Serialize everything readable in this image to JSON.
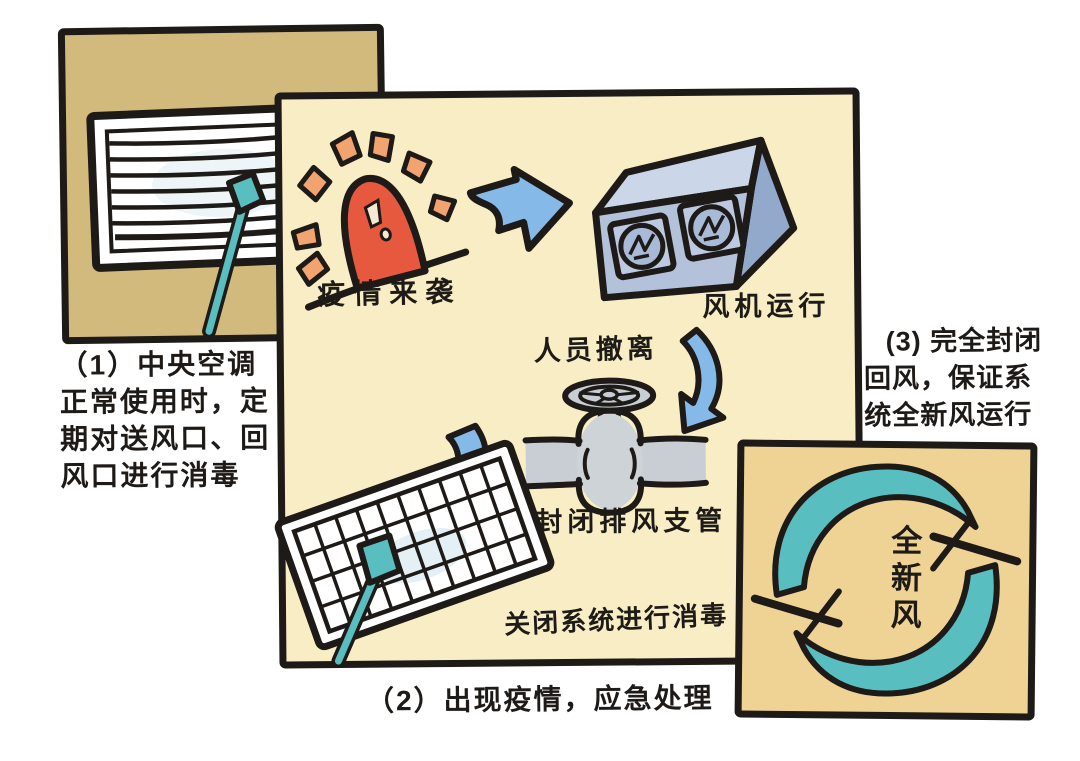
{
  "colors": {
    "ink": "#1d1a17",
    "panel1_bg": "#d2b97c",
    "panel2_bg": "#f8edc4",
    "panel3_bg": "#eed394",
    "arrow_blue": "#85bae8",
    "teal": "#58bec0",
    "siren_red": "#e7593e",
    "ray_orange": "#f2a470",
    "valve_gray": "#c9ced4",
    "fan_front": "#b3c1da",
    "fan_top": "#cbd6e9",
    "fan_side": "#93a9cc",
    "paper": "#ffffff"
  },
  "step1": {
    "caption": "（1）中央空调\n正常使用时，定\n期对送风口、回\n风口进行消毒"
  },
  "step2": {
    "caption": "（2）出现疫情，应急处理",
    "labels": {
      "alarm": "疫情来袭",
      "fan": "风机运行",
      "evacuate": "人员撤离",
      "valve": "封闭排风支管",
      "disinfect": "关闭系统进行消毒"
    }
  },
  "step3": {
    "caption": "(3) 完全封闭\n回风，保证系\n统全新风运行",
    "fresh_air": "全新风"
  },
  "icons": {
    "air-vent-icon": "white louvered grille with teal cleaning swab",
    "siren-icon": "red alarm dome with orange rays",
    "arrow-right-icon": "blue hand-drawn arrow",
    "fan-unit-icon": "3d box with two round fans",
    "curved-arrow-down-icon": "blue crescent arrow",
    "valve-icon": "gray pipe valve with handwheel",
    "small-arrow-down-left-icon": "blue crescent arrow",
    "grille-swab-icon": "tilted grid vent with teal swab",
    "recirculation-arrows-icon": "two teal circular crescents"
  }
}
